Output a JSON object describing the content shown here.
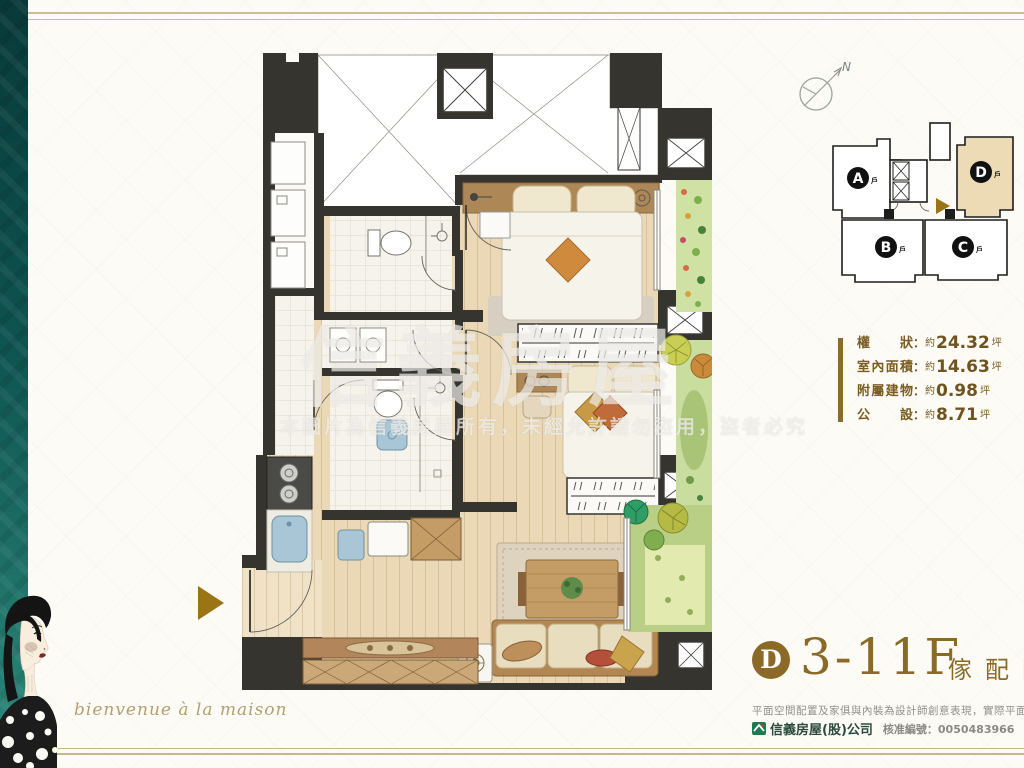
{
  "colors": {
    "accent_gold": "#8a6a26",
    "gold_line": "#cdbd96",
    "teal_bar": "#0e5450",
    "wall": "#35342f",
    "wood_floor": "#ead8b6",
    "highlight_unit": "#ecdbb4",
    "company_green": "#1e7a4f"
  },
  "compass": {
    "label": "N"
  },
  "keyplan": {
    "units": [
      {
        "id": "A",
        "suffix": "戶"
      },
      {
        "id": "B",
        "suffix": "戶"
      },
      {
        "id": "C",
        "suffix": "戶"
      },
      {
        "id": "D",
        "suffix": "戶"
      }
    ]
  },
  "area": {
    "colon": "：",
    "approx": "約",
    "unit": "坪",
    "rows": [
      {
        "label": "權　狀",
        "value": "24.32"
      },
      {
        "label": "室內面積",
        "value": "14.63"
      },
      {
        "label": "附屬建物",
        "value": "0.98"
      },
      {
        "label": "公　設",
        "value": "8.71"
      }
    ]
  },
  "title": {
    "badge": "D",
    "floors": "3-11F",
    "suffix": "傢配圖"
  },
  "footer": {
    "disclaimer": "平面空間配置及家俱與內裝為設計師創意表現，實際平面、屋況與坪數以",
    "company": "信義房屋(股)公司",
    "approval_label": "核准編號：",
    "approval_number": "0050483966"
  },
  "watermark": {
    "brand": "信義房屋",
    "notice": "本圖片為信義房屋所有，未經允許請勿盜用，盜者必究"
  },
  "tagline": "bienvenue à la maison"
}
